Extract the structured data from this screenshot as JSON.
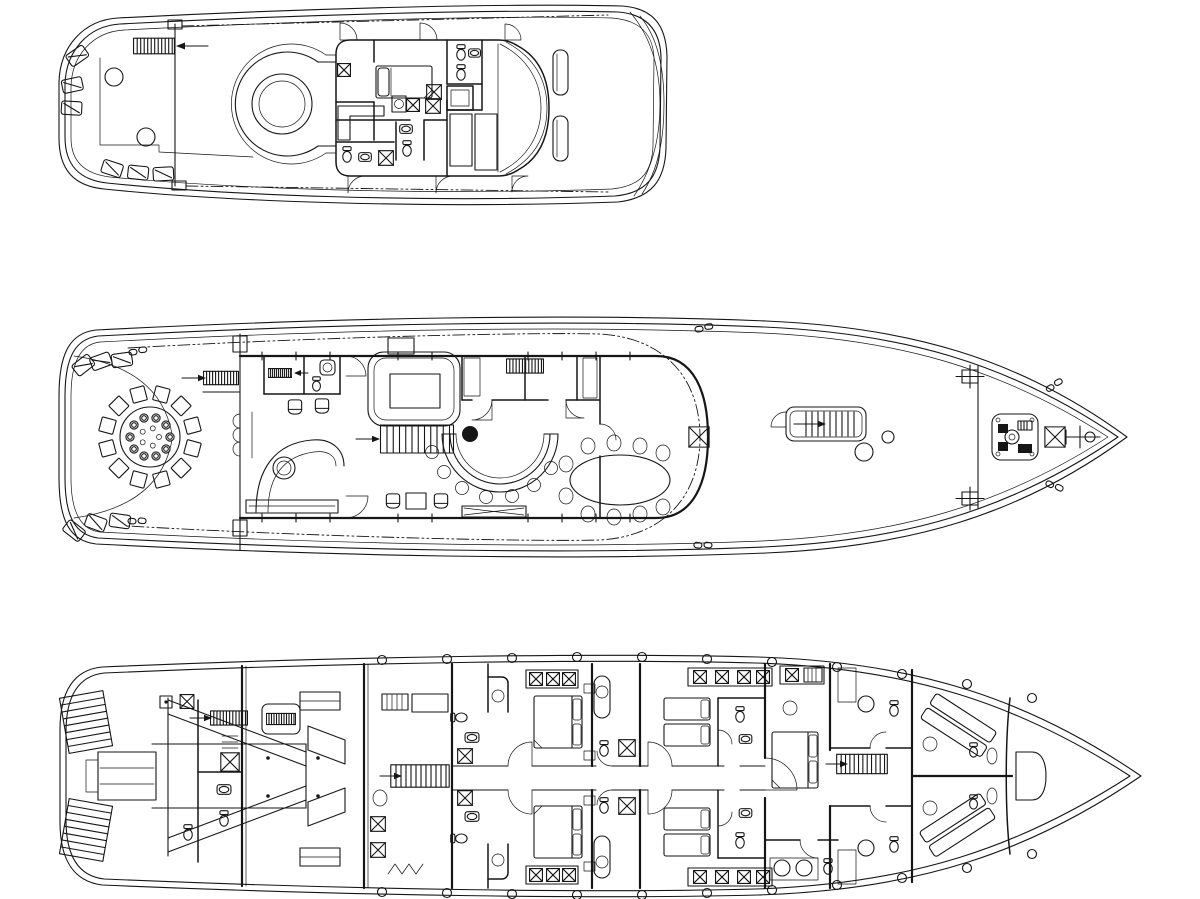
{
  "colors": {
    "ink": "#161616",
    "paper": "#ffffff"
  },
  "drawing": {
    "deck_count": 3,
    "decks": [
      {
        "id": "top-deck",
        "features": [
          "exterior-stairs-icon",
          "l-shaped-settee-icon",
          "cocktail-table-icon",
          "hot-tub-icon",
          "captain-cabin-bed-icon",
          "toilet-icon",
          "sink-icon",
          "storage-xbox-icon",
          "windshield-icon",
          "helm-seat-icon",
          "door-swing-icon"
        ]
      },
      {
        "id": "main-deck",
        "features": [
          "round-dining-table-12-seats-icon",
          "place-setting-icon",
          "lounge-chair-icon",
          "cleat-icon",
          "stair-icon",
          "day-head-icon",
          "curved-sofa-icon",
          "skylight-icon",
          "grand-staircase-icon",
          "semicircular-bar-icon",
          "bar-stool-icon",
          "column-icon",
          "oval-dining-table-10-seats-icon",
          "companionway-icon",
          "deck-hatch-icon",
          "windlass-icon",
          "anchor-staff-icon",
          "overhang-dashdot-line"
        ]
      },
      {
        "id": "lower-deck",
        "features": [
          "swim-steps-icon",
          "tender-garage-icon",
          "engine-room-icon",
          "stair-icon",
          "double-guest-cabin-icon",
          "twin-guest-cabin-icon",
          "vip-cabin-icon",
          "crew-bunk-icon",
          "ensuite-toilet-icon",
          "ensuite-sink-icon",
          "wardrobe-xbox-icon",
          "porthole-icon",
          "chain-locker-icon"
        ]
      }
    ]
  }
}
